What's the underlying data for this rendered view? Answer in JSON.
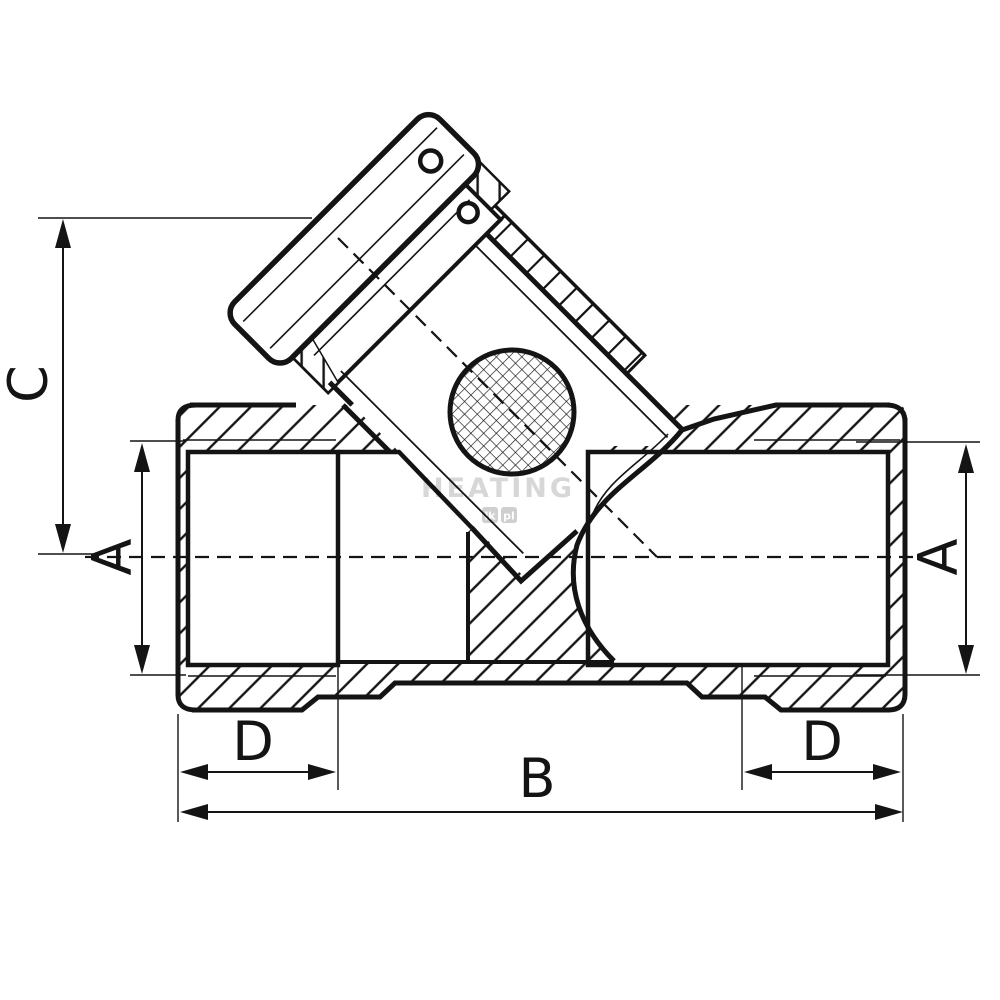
{
  "dimensions": {
    "branch_height": {
      "label": "C"
    },
    "port_diameter_left": {
      "label": "A"
    },
    "port_diameter_right": {
      "label": "A"
    },
    "thread_depth_left": {
      "label": "D"
    },
    "thread_depth_right": {
      "label": "D"
    },
    "overall_length": {
      "label": "B"
    }
  },
  "watermark": {
    "brand": "HEATING",
    "tag_left": "ik",
    "separator": ".",
    "tag_right": "pl"
  },
  "colors": {
    "line": "#141414",
    "background": "#ffffff",
    "watermark": "#d7d7d7",
    "watermark_tag": "#cfcfcf"
  }
}
